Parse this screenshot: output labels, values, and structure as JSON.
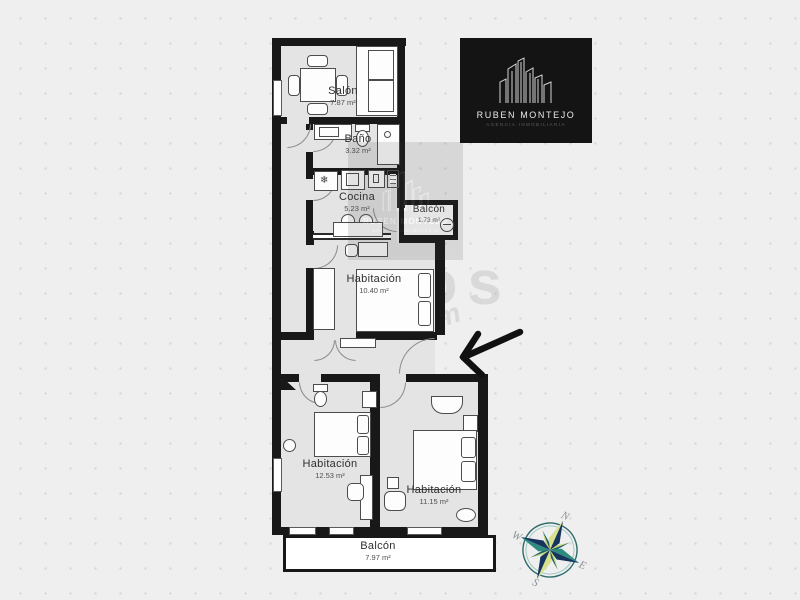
{
  "plan": {
    "rooms": [
      {
        "name": "Salón",
        "area": "7.87 m²"
      },
      {
        "name": "Baño",
        "area": "3.32 m²"
      },
      {
        "name": "Cocina",
        "area": "5.23 m²"
      },
      {
        "name": "Balcón",
        "area": "1.73 m²"
      },
      {
        "name": "Habitación",
        "area": "10.40 m²"
      },
      {
        "name": "Habitación",
        "area": "12.53 m²"
      },
      {
        "name": "Habitación",
        "area": "11.15 m²"
      },
      {
        "name": "Balcón",
        "area": "7.97 m²"
      }
    ],
    "icons": {
      "snowflake": "❄"
    }
  },
  "logo": {
    "name": "RUBEN MONTEJO",
    "tagline": "AGENCIA INMOBILIARIA"
  },
  "watermark": {
    "brand": "pisos",
    "suffix": ".com"
  },
  "compass": {
    "north": "N",
    "south": "S",
    "east": "E",
    "west": "W"
  },
  "colors": {
    "wall": "#181818",
    "floor": "#e4e4e4",
    "logo_bg": "#141414",
    "compass_navy": "#16345c",
    "compass_teal": "#2d8c80",
    "compass_light": "#d8e08c",
    "arrow": "#111111"
  }
}
